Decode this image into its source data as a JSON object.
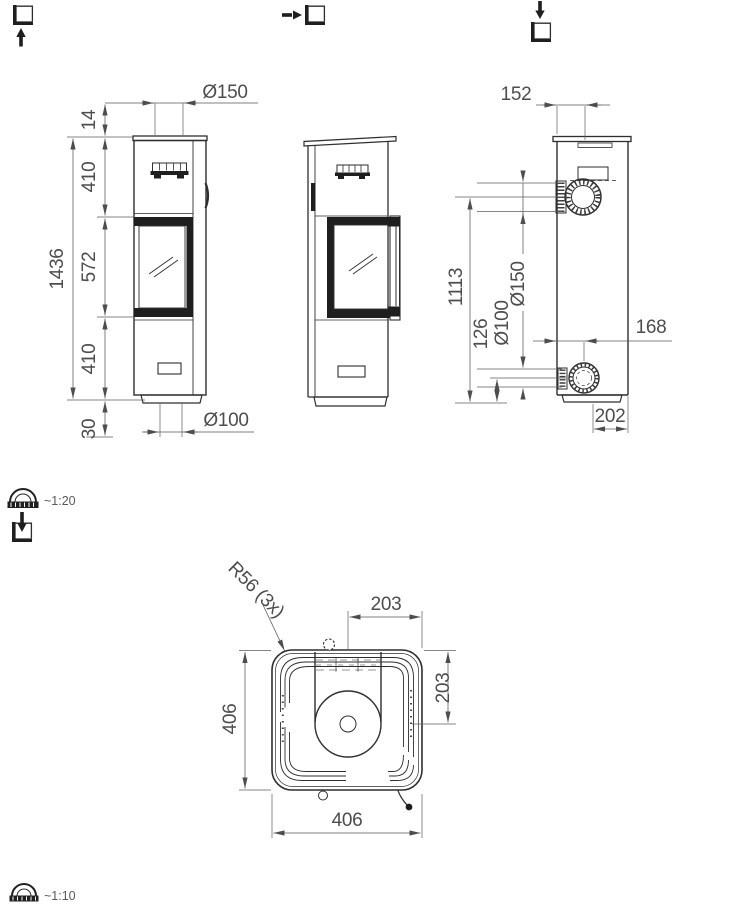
{
  "icons": {
    "view_front": "square-arrow-up-icon",
    "view_side": "square-arrow-right-icon",
    "view_top": "square-arrow-down-icon",
    "view_plan": "square-arrow-into-icon",
    "scale_elevation": "ruler-protractor-icon",
    "scale_plan": "ruler-protractor-icon"
  },
  "scales": {
    "elevation": "~1:20",
    "plan": "~1:10"
  },
  "front_view": {
    "dims": {
      "overall_height": "1436",
      "collar": "14",
      "upper": "410",
      "middle": "572",
      "lower": "410",
      "base": "30",
      "flue_dia": "Ø150",
      "inlet_dia": "Ø100"
    }
  },
  "side_view": {
    "dims": {
      "flue_offset": "152",
      "flue_height": "1113",
      "inlet_height": "126",
      "inlet_dia": "Ø100",
      "flue_dia": "Ø150",
      "inlet_offset": "168",
      "base_depth": "202"
    }
  },
  "plan_view": {
    "dims": {
      "corner_radius": "R56 (3x)",
      "offset_x": "203",
      "offset_y": "203",
      "width": "406",
      "depth": "406"
    }
  }
}
